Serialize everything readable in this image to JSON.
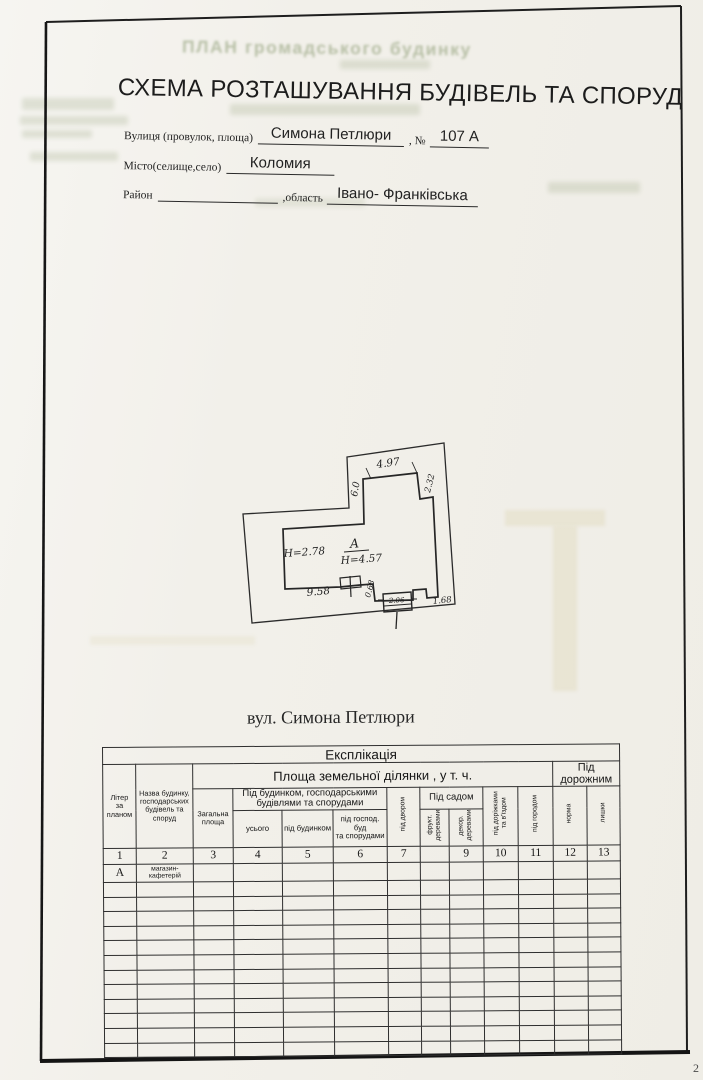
{
  "page": {
    "number": "2"
  },
  "ghost": {
    "reverse_title": "ПЛАН громадського будинку"
  },
  "header": {
    "title": "СХЕМА РОЗТАШУВАННЯ БУДІВЕЛЬ ТА СПОРУД",
    "street_label": "Вулиця (провулок, площа)",
    "street_value": "Симона Петлюри",
    "number_label": ", №",
    "number_value": "107 А",
    "city_label": "Місто(селище,село)",
    "city_value": "Коломия",
    "district_label": "Район",
    "region_label": ",область",
    "region_value": "Івано- Франківська"
  },
  "plan": {
    "caption": "вул. Симона Петлюри",
    "building_letter": "А",
    "building_height": "Н=4.57",
    "left_height": "Н=2.78",
    "dim_top": "4.97",
    "dim_right": "2.32",
    "dim_left": "6.0",
    "dim_bottom": "9.58",
    "dim_step": "0.68",
    "dim_gate": "2.06",
    "dim_bottom_right": "1.68"
  },
  "table": {
    "title": "Експлікація",
    "col_liter": "Літер\nза\nпланом",
    "col_name": "Назва будинку,\nгосподарських\nбудівель та\nспоруд",
    "area_group": "Площа земельної ділянки , у т. ч.",
    "road_group": "Під дорожним",
    "col_total": "Загальна\nплоща",
    "under_building_group": "Під будинком, господарськими\nбудівлями та спорудами",
    "col_all": "усього",
    "col_under_house": "під будинком",
    "col_under_hoz": "під господ. буд\nта спорудами",
    "col_yard": "під двором",
    "garden_group": "Під садом",
    "col_fruit": "фрукт.\nдеревами",
    "col_decor": "декор.\nдеревами",
    "col_paths": "під доріжками\nта в'їздом",
    "col_garden2": "під городом",
    "col_norm": "норма",
    "col_excess": "лишки",
    "numbers": [
      "1",
      "2",
      "3",
      "4",
      "5",
      "6",
      "7",
      "",
      "9",
      "10",
      "11",
      "12",
      "13"
    ],
    "row_a": {
      "liter": "А",
      "name": "магазин-\nкафетерій"
    },
    "empty_row_count": 12
  }
}
